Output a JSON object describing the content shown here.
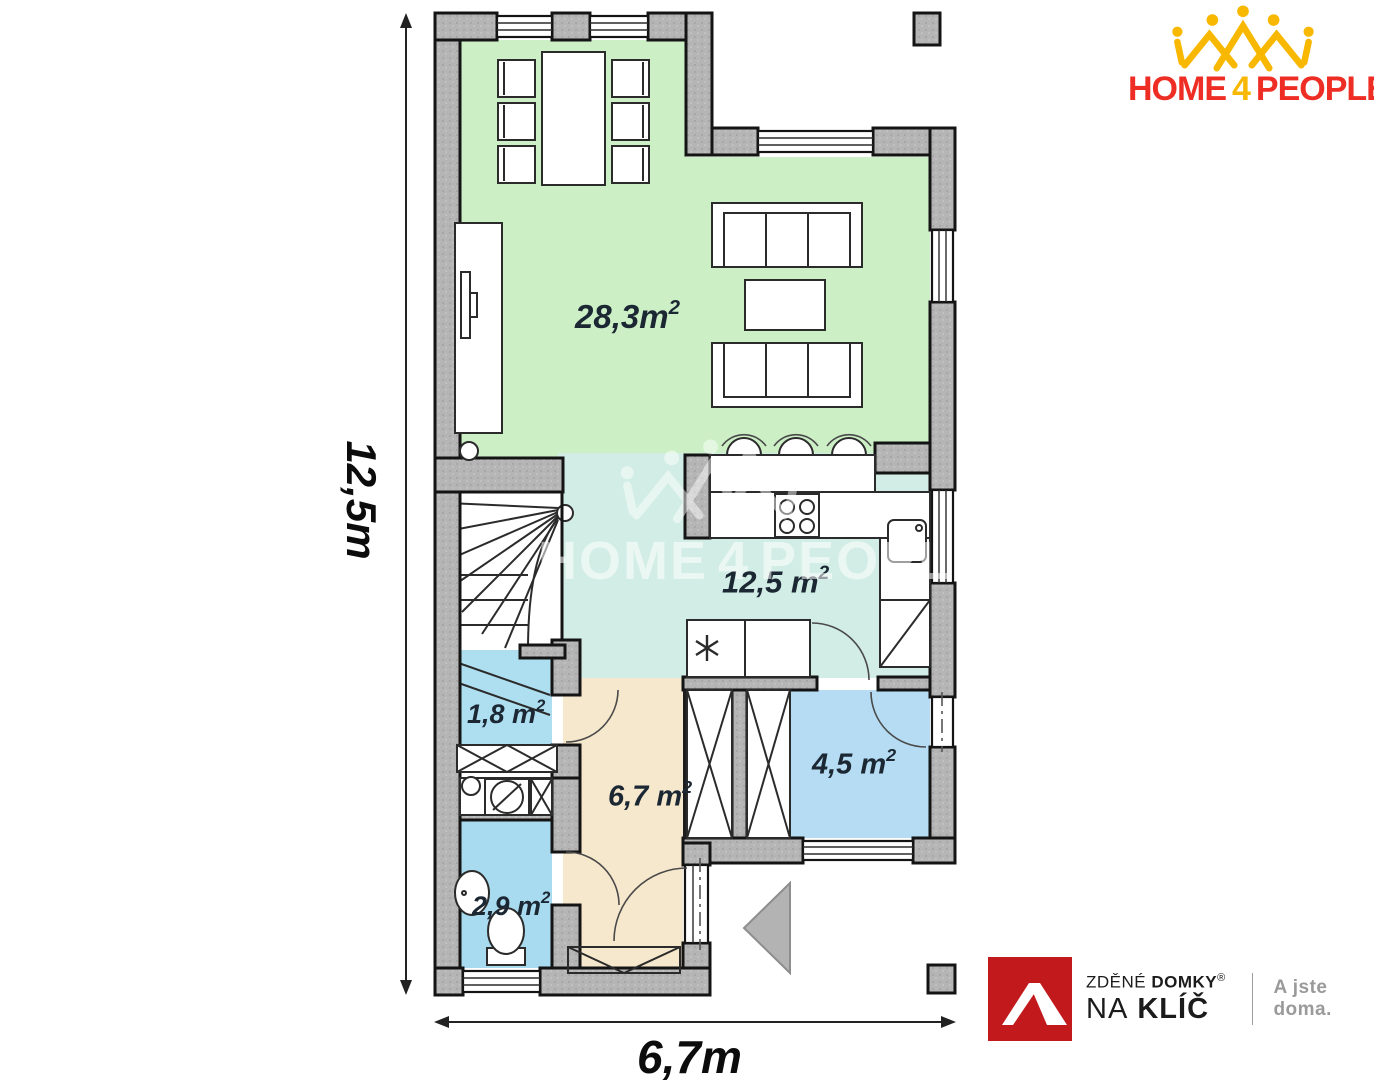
{
  "brand": {
    "word1": "HOME",
    "word2": "4",
    "word3": "PEOPLE"
  },
  "plan": {
    "rooms": [
      {
        "name": "living-dining",
        "area": "28,3m",
        "sup": "2"
      },
      {
        "name": "kitchen",
        "area": "12,5 m",
        "sup": "2"
      },
      {
        "name": "storage",
        "area": "1,8 m",
        "sup": "2"
      },
      {
        "name": "hall",
        "area": "6,7 m",
        "sup": "2"
      },
      {
        "name": "bathroom",
        "area": "4,5 m",
        "sup": "2"
      },
      {
        "name": "wc",
        "area": "2,9 m",
        "sup": "2"
      }
    ],
    "dims": {
      "height": "12,5m",
      "width": "6,7m"
    }
  },
  "partner": {
    "line1_light": "ZDĚNÉ",
    "line1_bold": "DOMKY",
    "reg": "®",
    "line2_light": "NA",
    "line2_bold": "KLÍČ",
    "tagline": "A jste doma."
  },
  "colors": {
    "wall_gray": "#b5b5b5",
    "living_green": "#ccefc6",
    "kitchen_teal": "#d2ede5",
    "hall_beige": "#f6e8cc",
    "storage_blue": "#aedff0",
    "bath_blue": "#b5dcf2",
    "wc_blue": "#a9dbf0",
    "brand_red": "#ee2e24",
    "brand_gold": "#f8b800",
    "partner_red": "#c2191d",
    "label_ink": "#1b2733",
    "tagline_gray": "#9a9a9a"
  }
}
